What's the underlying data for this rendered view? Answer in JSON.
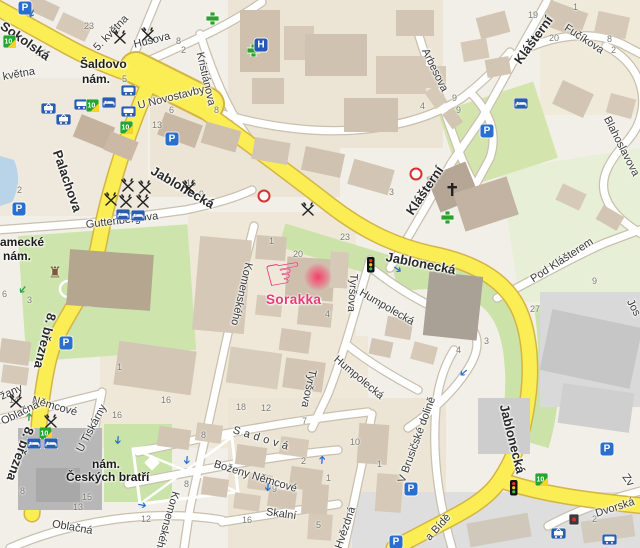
{
  "app": {
    "type": "city-map"
  },
  "colors": {
    "background": "#f2efe8",
    "road_major": "#fbee54",
    "road_major_casing": "#d4b445",
    "road_minor": "#ffffff",
    "road_minor_casing": "#c9c0ae",
    "park_green": "#cde4ab",
    "pale_green": "#e7efd6",
    "water": "#b9d3e8",
    "building": "#d2c5b3",
    "building_dark": "#b3a494",
    "building_gray": "#c6c6c6",
    "label": "#333333",
    "marker_pink": "#e73b76",
    "transit_blue": "#2a5db0",
    "poi_green": "#2ca12c"
  },
  "marker": {
    "label": "Sorakka",
    "hand_glyph": "☞"
  },
  "street_labels": [
    {
      "t": "Sokolská",
      "x": 2,
      "y": 18,
      "r": 35,
      "cls": "big"
    },
    {
      "t": "května",
      "x": 3,
      "y": 72,
      "r": -10
    },
    {
      "t": "5. května",
      "x": 96,
      "y": 44,
      "r": -46
    },
    {
      "t": "Husova",
      "x": 134,
      "y": 40,
      "r": -14
    },
    {
      "t": "Kristiánova",
      "x": 199,
      "y": 47,
      "r": 77
    },
    {
      "t": "U Novostavby",
      "x": 138,
      "y": 101,
      "r": -14
    },
    {
      "t": "Jablonecká",
      "x": 152,
      "y": 163,
      "r": 30,
      "cls": "big"
    },
    {
      "t": "Jablonecká",
      "x": 386,
      "y": 250,
      "r": 11,
      "cls": "big"
    },
    {
      "t": "Jablonecká",
      "x": 504,
      "y": 398,
      "r": 76,
      "cls": "big"
    },
    {
      "t": "Klášterní",
      "x": 517,
      "y": 56,
      "r": -54,
      "cls": "big"
    },
    {
      "t": "Klášterní",
      "x": 409,
      "y": 207,
      "r": -56,
      "cls": "big"
    },
    {
      "t": "Fučíkova",
      "x": 565,
      "y": 22,
      "r": 33
    },
    {
      "t": "Arbesova",
      "x": 424,
      "y": 44,
      "r": 64
    },
    {
      "t": "Blahoslavova",
      "x": 606,
      "y": 112,
      "r": 63
    },
    {
      "t": "Pod Klášterem",
      "x": 532,
      "y": 275,
      "r": -33
    },
    {
      "t": "Guttenbergova",
      "x": 86,
      "y": 220,
      "r": -7
    },
    {
      "t": "Palachova",
      "x": 57,
      "y": 144,
      "r": 71,
      "cls": "big"
    },
    {
      "t": "8. března",
      "x": 52,
      "y": 307,
      "r": 104,
      "cls": "big"
    },
    {
      "t": "8. března",
      "x": 30,
      "y": 421,
      "r": 110,
      "cls": "big"
    },
    {
      "t": "Němcové",
      "x": 32,
      "y": 395,
      "r": 16
    },
    {
      "t": "U Tiskárny",
      "x": 80,
      "y": 446,
      "r": -62
    },
    {
      "t": "Komenského",
      "x": 248,
      "y": 257,
      "r": 103
    },
    {
      "t": "Komenského",
      "x": 175,
      "y": 486,
      "r": 106
    },
    {
      "t": "Tyršova",
      "x": 353,
      "y": 268,
      "r": 94
    },
    {
      "t": "Tyršova",
      "x": 312,
      "y": 364,
      "r": 102
    },
    {
      "t": "Humpolecká",
      "x": 360,
      "y": 287,
      "r": 30
    },
    {
      "t": "Humpolecká",
      "x": 335,
      "y": 353,
      "r": 40
    },
    {
      "t": "Sadová",
      "x": 233,
      "y": 425,
      "r": 17,
      "ls": 4
    },
    {
      "t": "Boženy Němcové",
      "x": 214,
      "y": 459,
      "r": 17
    },
    {
      "t": "Skalní",
      "x": 266,
      "y": 507,
      "r": 8
    },
    {
      "t": "Hvězdná",
      "x": 339,
      "y": 543,
      "r": -71
    },
    {
      "t": "V Brusičské dolině",
      "x": 402,
      "y": 477,
      "r": -70
    },
    {
      "t": "Oblačná",
      "x": 52,
      "y": 519,
      "r": 10
    },
    {
      "t": "Oblačná",
      "x": 2,
      "y": 417,
      "r": -26
    },
    {
      "t": "žany",
      "x": 1,
      "y": 392,
      "r": -24
    },
    {
      "t": "Dvorská",
      "x": 596,
      "y": 509,
      "r": -18
    },
    {
      "t": "Zv",
      "x": 624,
      "y": 470,
      "r": 55
    },
    {
      "t": "a Bídě",
      "x": 428,
      "y": 534,
      "r": -48
    },
    {
      "t": "Jos",
      "x": 629,
      "y": 295,
      "r": 62
    }
  ],
  "place_labels": [
    {
      "t": "Šaldovo",
      "x": 80,
      "y": 58
    },
    {
      "t": "nám.",
      "x": 82,
      "y": 73
    },
    {
      "t": "amecké",
      "x": 0,
      "y": 236
    },
    {
      "t": "nám.",
      "x": 3,
      "y": 250
    },
    {
      "t": "nám.",
      "x": 92,
      "y": 458
    },
    {
      "t": "Českých bratří",
      "x": 66,
      "y": 471
    }
  ],
  "house_numbers": [
    {
      "t": "17",
      "x": 36,
      "y": 49
    },
    {
      "t": "23",
      "x": 84,
      "y": 22
    },
    {
      "t": "16",
      "x": 110,
      "y": 25
    },
    {
      "t": "8",
      "x": 176,
      "y": 37
    },
    {
      "t": "2",
      "x": 181,
      "y": 46
    },
    {
      "t": "5",
      "x": 122,
      "y": 75
    },
    {
      "t": "13",
      "x": 152,
      "y": 121
    },
    {
      "t": "6",
      "x": 169,
      "y": 106
    },
    {
      "t": "8",
      "x": 214,
      "y": 106
    },
    {
      "t": "16",
      "x": 186,
      "y": 179
    },
    {
      "t": "9",
      "x": 199,
      "y": 190
    },
    {
      "t": "1",
      "x": 74,
      "y": 201
    },
    {
      "t": "2",
      "x": 17,
      "y": 186
    },
    {
      "t": "6",
      "x": 2,
      "y": 290
    },
    {
      "t": "3",
      "x": 27,
      "y": 296
    },
    {
      "t": "4",
      "x": 420,
      "y": 102
    },
    {
      "t": "9",
      "x": 452,
      "y": 94
    },
    {
      "t": "9",
      "x": 456,
      "y": 106
    },
    {
      "t": "19",
      "x": 528,
      "y": 11
    },
    {
      "t": "20",
      "x": 549,
      "y": 34
    },
    {
      "t": "1",
      "x": 573,
      "y": 3
    },
    {
      "t": "8",
      "x": 607,
      "y": 35
    },
    {
      "t": "2",
      "x": 611,
      "y": 46
    },
    {
      "t": "23",
      "x": 340,
      "y": 233
    },
    {
      "t": "20",
      "x": 293,
      "y": 250
    },
    {
      "t": "1",
      "x": 269,
      "y": 237
    },
    {
      "t": "3",
      "x": 389,
      "y": 188
    },
    {
      "t": "4",
      "x": 325,
      "y": 310
    },
    {
      "t": "9",
      "x": 592,
      "y": 277
    },
    {
      "t": "27",
      "x": 530,
      "y": 305
    },
    {
      "t": "3",
      "x": 484,
      "y": 337
    },
    {
      "t": "4",
      "x": 456,
      "y": 346
    },
    {
      "t": "1",
      "x": 117,
      "y": 363
    },
    {
      "t": "16",
      "x": 161,
      "y": 396
    },
    {
      "t": "14",
      "x": 9,
      "y": 396
    },
    {
      "t": "16",
      "x": 112,
      "y": 411
    },
    {
      "t": "18",
      "x": 236,
      "y": 403
    },
    {
      "t": "12",
      "x": 261,
      "y": 404
    },
    {
      "t": "8",
      "x": 201,
      "y": 431
    },
    {
      "t": "7",
      "x": 302,
      "y": 417
    },
    {
      "t": "10",
      "x": 350,
      "y": 438
    },
    {
      "t": "2",
      "x": 301,
      "y": 457
    },
    {
      "t": "1",
      "x": 326,
      "y": 474
    },
    {
      "t": "1",
      "x": 377,
      "y": 460
    },
    {
      "t": "9",
      "x": 272,
      "y": 485
    },
    {
      "t": "8",
      "x": 184,
      "y": 480
    },
    {
      "t": "5",
      "x": 316,
      "y": 521
    },
    {
      "t": "15",
      "x": 82,
      "y": 493
    },
    {
      "t": "13",
      "x": 73,
      "y": 503
    },
    {
      "t": "12",
      "x": 141,
      "y": 515
    },
    {
      "t": "16",
      "x": 242,
      "y": 516
    },
    {
      "t": "8",
      "x": 20,
      "y": 487
    },
    {
      "t": "2",
      "x": 592,
      "y": 515
    }
  ],
  "icons": [
    {
      "type": "parking",
      "x": 25,
      "y": 8
    },
    {
      "type": "parking",
      "x": 172,
      "y": 139
    },
    {
      "type": "parking",
      "x": 19,
      "y": 209
    },
    {
      "type": "parking",
      "x": 66,
      "y": 343
    },
    {
      "type": "parking",
      "x": 487,
      "y": 131
    },
    {
      "type": "parking",
      "x": 607,
      "y": 449
    },
    {
      "type": "parking",
      "x": 411,
      "y": 489
    },
    {
      "type": "parking",
      "x": 396,
      "y": 542
    },
    {
      "type": "tram",
      "x": 41,
      "y": 102
    },
    {
      "type": "tram",
      "x": 56,
      "y": 113
    },
    {
      "type": "tram",
      "x": 551,
      "y": 527
    },
    {
      "type": "bus",
      "x": 74,
      "y": 99
    },
    {
      "type": "bus",
      "x": 121,
      "y": 85
    },
    {
      "type": "bus",
      "x": 121,
      "y": 106
    },
    {
      "type": "bus",
      "x": 602,
      "y": 534
    },
    {
      "type": "transit10",
      "x": 86,
      "y": 99
    },
    {
      "type": "transit10",
      "x": 120,
      "y": 121
    },
    {
      "type": "transit10",
      "x": 39,
      "y": 427
    },
    {
      "type": "transit10",
      "x": 535,
      "y": 473
    },
    {
      "type": "transit10",
      "x": 3,
      "y": 35
    },
    {
      "type": "hotel",
      "x": 102,
      "y": 97
    },
    {
      "type": "hotel",
      "x": 116,
      "y": 209
    },
    {
      "type": "hotel",
      "x": 131,
      "y": 210
    },
    {
      "type": "hotel",
      "x": 27,
      "y": 438
    },
    {
      "type": "hotel",
      "x": 44,
      "y": 438
    },
    {
      "type": "hotel",
      "x": 514,
      "y": 98
    },
    {
      "type": "restaurant",
      "x": 112,
      "y": 30
    },
    {
      "type": "restaurant",
      "x": 140,
      "y": 27
    },
    {
      "type": "restaurant",
      "x": 103,
      "y": 192
    },
    {
      "type": "restaurant",
      "x": 118,
      "y": 194
    },
    {
      "type": "restaurant",
      "x": 135,
      "y": 194
    },
    {
      "type": "restaurant",
      "x": 120,
      "y": 178
    },
    {
      "type": "restaurant",
      "x": 137,
      "y": 180
    },
    {
      "type": "restaurant",
      "x": 181,
      "y": 180
    },
    {
      "type": "restaurant",
      "x": 300,
      "y": 202
    },
    {
      "type": "restaurant",
      "x": 8,
      "y": 394
    },
    {
      "type": "restaurant",
      "x": 43,
      "y": 414
    },
    {
      "type": "pharmacy",
      "x": 206,
      "y": 12
    },
    {
      "type": "pharmacy",
      "x": 247,
      "y": 44
    },
    {
      "type": "pharmacy",
      "x": 441,
      "y": 211
    },
    {
      "type": "hospital",
      "x": 261,
      "y": 45
    },
    {
      "type": "church",
      "x": 446,
      "y": 183
    },
    {
      "type": "castle",
      "x": 55,
      "y": 273
    },
    {
      "type": "traffic",
      "x": 367,
      "y": 257
    },
    {
      "type": "traffic",
      "x": 510,
      "y": 480
    },
    {
      "type": "arrowb",
      "x": 31,
      "y": 13,
      "r": 115
    },
    {
      "type": "arrowb",
      "x": 117,
      "y": 440,
      "r": 95
    },
    {
      "type": "arrowb",
      "x": 186,
      "y": 460,
      "r": 95
    },
    {
      "type": "arrowb",
      "x": 142,
      "y": 506,
      "r": 10
    },
    {
      "type": "arrowb",
      "x": 323,
      "y": 460,
      "r": -85
    },
    {
      "type": "arrowb",
      "x": 267,
      "y": 487,
      "r": 95
    },
    {
      "type": "arrowb",
      "x": 463,
      "y": 372,
      "r": 140
    },
    {
      "type": "arrowb",
      "x": 397,
      "y": 270,
      "r": 35
    },
    {
      "type": "arrowg",
      "x": 22,
      "y": 289,
      "r": 130
    },
    {
      "type": "arrowg",
      "x": 30,
      "y": 417,
      "r": -85
    },
    {
      "type": "noentry",
      "x": 416,
      "y": 174
    },
    {
      "type": "noentry",
      "x": 264,
      "y": 196
    },
    {
      "type": "stopdark",
      "x": 569,
      "y": 514
    }
  ]
}
